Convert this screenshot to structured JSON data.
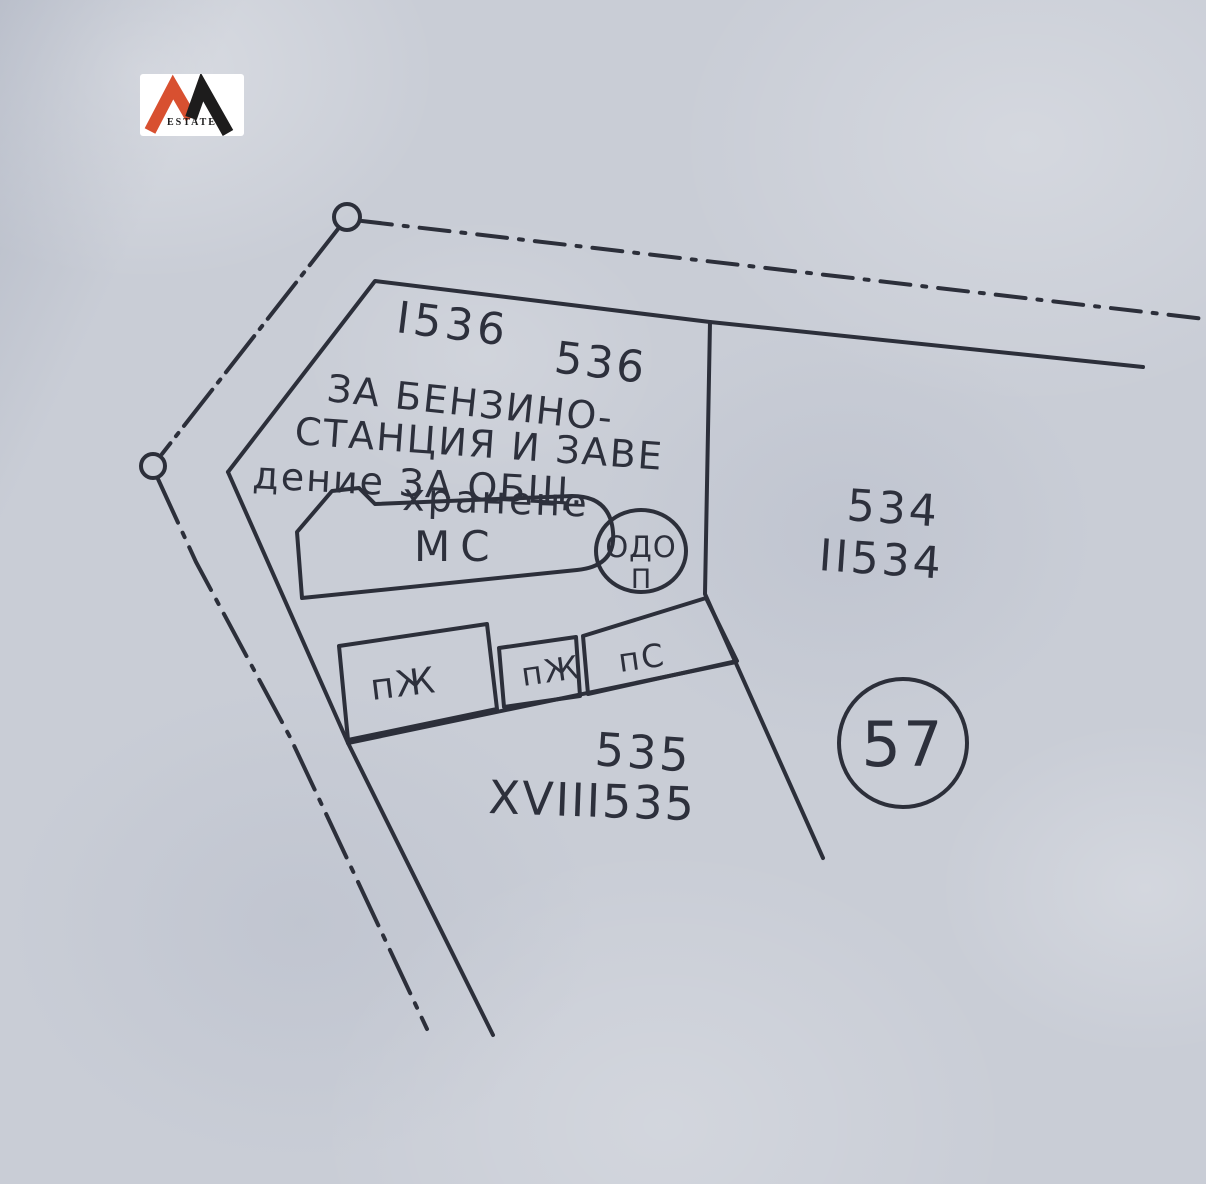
{
  "logo": {
    "name": "ESTATE",
    "orange": "#d85030",
    "black": "#1d1c1c"
  },
  "labels": {
    "parcel_536_roman": "I536",
    "parcel_536": "536",
    "note_line1": "ЗА БЕНЗИНО-",
    "note_line2": "СТАНЦИЯ И ЗАВЕ",
    "note_line3": "дение ЗА ОБЩ.",
    "note_line4": "хранене",
    "building_main": "МС",
    "building_circle": "ОДО",
    "building_circle_sub": "П",
    "parcel_534": "534",
    "parcel_534_roman": "II534",
    "shed_left": "пЖ",
    "shed_mid": "пЖ",
    "shed_right": "пС",
    "parcel_535": "535",
    "parcel_535_roman": "XVIII535",
    "plot_number": "57"
  },
  "colors": {
    "paper": "#c9cdd6",
    "ink": "#2c2f3a"
  }
}
